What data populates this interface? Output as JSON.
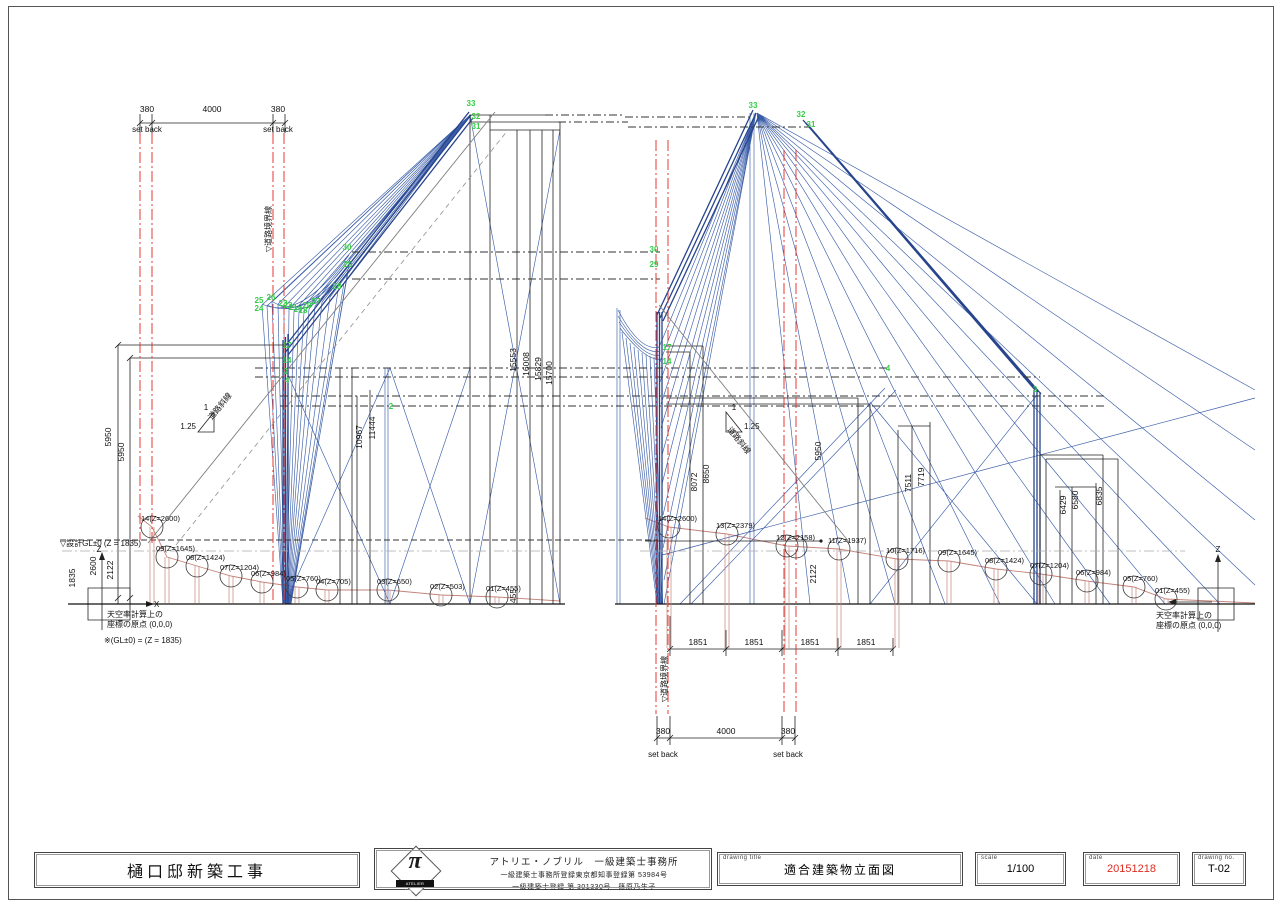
{
  "sheet": {
    "project": "樋口邸新築工事",
    "office_name": "アトリエ・ノブリル　一級建築士事務所",
    "office_reg1": "一級建築士事務所登録東京都知事登録第 53984号",
    "office_reg2": "一級建築士登録 第 301330号　篠原乃生子",
    "logo_mark": "π",
    "logo_name": "ATELIER NOMBRIL",
    "label_drawing_title": "drawing title",
    "label_scale": "scale",
    "label_date": "date",
    "label_drawing_no": "drawing no.",
    "drawing_title": "適合建築物立面図",
    "scale": "1/100",
    "date": "20151218",
    "drawing_no": "T-02",
    "date_color": "#e02b20",
    "accent_road_line": "#e53935",
    "accent_sky_lines": "#3b5ea9",
    "accent_points": "#35cc47"
  },
  "drawing": {
    "dims": [
      {
        "t": "380",
        "x": 147,
        "y": 112
      },
      {
        "t": "4000",
        "x": 212,
        "y": 112
      },
      {
        "t": "380",
        "x": 278,
        "y": 112
      },
      {
        "t": "5950",
        "x": 111,
        "y": 437,
        "r": -90
      },
      {
        "t": "5950",
        "x": 124,
        "y": 452,
        "r": -90
      },
      {
        "t": "1835",
        "x": 75,
        "y": 578,
        "r": -90
      },
      {
        "t": "2600",
        "x": 96,
        "y": 566,
        "r": -90
      },
      {
        "t": "2122",
        "x": 113,
        "y": 570,
        "r": -90
      },
      {
        "t": "10967",
        "x": 362,
        "y": 437,
        "r": -90
      },
      {
        "t": "11444",
        "x": 375,
        "y": 428,
        "r": -90
      },
      {
        "t": "15553",
        "x": 516,
        "y": 360,
        "r": -90
      },
      {
        "t": "16008",
        "x": 529,
        "y": 364,
        "r": -90
      },
      {
        "t": "15829",
        "x": 541,
        "y": 369,
        "r": -90
      },
      {
        "t": "15700",
        "x": 552,
        "y": 373,
        "r": -90
      },
      {
        "t": "455",
        "x": 516,
        "y": 596,
        "r": -90
      },
      {
        "t": "8072",
        "x": 697,
        "y": 482,
        "r": -90
      },
      {
        "t": "8650",
        "x": 709,
        "y": 474,
        "r": -90
      },
      {
        "t": "5950",
        "x": 821,
        "y": 451,
        "r": -90
      },
      {
        "t": "2122",
        "x": 816,
        "y": 574,
        "r": -90
      },
      {
        "t": "7511",
        "x": 911,
        "y": 483,
        "r": -90
      },
      {
        "t": "7719",
        "x": 924,
        "y": 477,
        "r": -90
      },
      {
        "t": "6429",
        "x": 1066,
        "y": 505,
        "r": -90
      },
      {
        "t": "6580",
        "x": 1078,
        "y": 500,
        "r": -90
      },
      {
        "t": "6835",
        "x": 1102,
        "y": 496,
        "r": -90
      },
      {
        "t": "1851",
        "x": 698,
        "y": 645
      },
      {
        "t": "1851",
        "x": 754,
        "y": 645
      },
      {
        "t": "1851",
        "x": 810,
        "y": 645
      },
      {
        "t": "1851",
        "x": 866,
        "y": 645
      },
      {
        "t": "380",
        "x": 663,
        "y": 734
      },
      {
        "t": "4000",
        "x": 726,
        "y": 734
      },
      {
        "t": "380",
        "x": 788,
        "y": 734
      }
    ],
    "notes": [
      {
        "t": "set back",
        "x": 147,
        "y": 132
      },
      {
        "t": "set back",
        "x": 278,
        "y": 132
      },
      {
        "t": "set back",
        "x": 663,
        "y": 757
      },
      {
        "t": "set back",
        "x": 788,
        "y": 757
      },
      {
        "t": "▽道路境界線",
        "x": 271,
        "y": 252,
        "a": "start",
        "r": -90
      },
      {
        "t": "▽道路境界線",
        "x": 667,
        "y": 702,
        "a": "start",
        "r": -90
      },
      {
        "t": "▽設計GL±0 (Z = 1835)",
        "x": 60,
        "y": 546,
        "a": "start"
      },
      {
        "t": "天空率計算上の",
        "x": 107,
        "y": 617,
        "a": "start"
      },
      {
        "t": "座標の原点 (0,0,0)",
        "x": 107,
        "y": 627,
        "a": "start"
      },
      {
        "t": "※(GL±0) = (Z = 1835)",
        "x": 104,
        "y": 643,
        "a": "start"
      },
      {
        "t": "天空率計算上の",
        "x": 1156,
        "y": 618,
        "a": "start"
      },
      {
        "t": "座標の原点 (0,0,0)",
        "x": 1156,
        "y": 628,
        "a": "start"
      },
      {
        "t": "道路斜線",
        "x": 222,
        "y": 408,
        "r": -51
      },
      {
        "t": "道路斜線",
        "x": 737,
        "y": 442,
        "r": 51
      },
      {
        "t": "1.25",
        "x": 196,
        "y": 429,
        "a": "end"
      },
      {
        "t": "1",
        "x": 206,
        "y": 410
      },
      {
        "t": "1.25",
        "x": 744,
        "y": 429,
        "a": "start"
      },
      {
        "t": "1",
        "x": 734,
        "y": 410
      },
      {
        "t": "Z",
        "x": 99,
        "y": 552
      },
      {
        "t": "X",
        "x": 154,
        "y": 607,
        "a": "start"
      },
      {
        "t": "Z",
        "x": 1218,
        "y": 552
      }
    ],
    "points": [
      {
        "t": "33",
        "x": 471,
        "y": 106
      },
      {
        "t": "32",
        "x": 476,
        "y": 119
      },
      {
        "t": "31",
        "x": 476,
        "y": 129
      },
      {
        "t": "33",
        "x": 753,
        "y": 108
      },
      {
        "t": "32",
        "x": 801,
        "y": 117
      },
      {
        "t": "31",
        "x": 811,
        "y": 127
      },
      {
        "t": "30",
        "x": 347,
        "y": 250
      },
      {
        "t": "29",
        "x": 348,
        "y": 267
      },
      {
        "t": "28",
        "x": 337,
        "y": 289
      },
      {
        "t": "25",
        "x": 259,
        "y": 303
      },
      {
        "t": "24",
        "x": 259,
        "y": 311
      },
      {
        "t": "26",
        "x": 271,
        "y": 300
      },
      {
        "t": "23",
        "x": 283,
        "y": 306
      },
      {
        "t": "22",
        "x": 288,
        "y": 308
      },
      {
        "t": "21",
        "x": 293,
        "y": 310
      },
      {
        "t": "19",
        "x": 298,
        "y": 312
      },
      {
        "t": "18",
        "x": 303,
        "y": 313
      },
      {
        "t": "20",
        "x": 307,
        "y": 308
      },
      {
        "t": "27",
        "x": 316,
        "y": 304
      },
      {
        "t": "17",
        "x": 287,
        "y": 348
      },
      {
        "t": "14",
        "x": 287,
        "y": 363
      },
      {
        "t": "3",
        "x": 286,
        "y": 374
      },
      {
        "t": "4",
        "x": 287,
        "y": 383
      },
      {
        "t": "2",
        "x": 391,
        "y": 409
      },
      {
        "t": "30",
        "x": 654,
        "y": 252
      },
      {
        "t": "29",
        "x": 654,
        "y": 267
      },
      {
        "t": "17",
        "x": 667,
        "y": 350
      },
      {
        "t": "14",
        "x": 667,
        "y": 364
      },
      {
        "t": "4",
        "x": 888,
        "y": 371
      },
      {
        "t": "3",
        "x": 1035,
        "y": 392
      }
    ],
    "markers": [
      {
        "t": "14(Z=2600)",
        "cx": 152,
        "cy": 527,
        "side": "L"
      },
      {
        "t": "09(Z=1645)",
        "cx": 167,
        "cy": 557,
        "side": "L"
      },
      {
        "t": "08(Z=1424)",
        "cx": 197,
        "cy": 566,
        "side": "L"
      },
      {
        "t": "07(Z=1204)",
        "cx": 231,
        "cy": 576,
        "side": "L"
      },
      {
        "t": "06(Z=984)",
        "cx": 262,
        "cy": 582,
        "side": "L"
      },
      {
        "t": "05(Z=760)",
        "cx": 297,
        "cy": 587,
        "side": "L"
      },
      {
        "t": "04(Z=705)",
        "cx": 327,
        "cy": 590,
        "side": "L"
      },
      {
        "t": "03(Z=650)",
        "cx": 388,
        "cy": 590,
        "side": "L"
      },
      {
        "t": "02(Z=503)",
        "cx": 441,
        "cy": 595,
        "side": "L"
      },
      {
        "t": "01(Z=455)",
        "cx": 497,
        "cy": 597,
        "side": "L"
      },
      {
        "t": "14(Z=2600)",
        "cx": 669,
        "cy": 527,
        "side": "R",
        "deep": 1
      },
      {
        "t": "13(Z=2379)",
        "cx": 727,
        "cy": 534,
        "side": "R",
        "deep": 1
      },
      {
        "t": "12(Z=2158)",
        "cx": 787,
        "cy": 546,
        "c2": 796,
        "side": "R",
        "deep": 1
      },
      {
        "t": "11(Z=1937)",
        "cx": 839,
        "cy": 549,
        "side": "R",
        "deep": 1
      },
      {
        "t": "10(Z=1716)",
        "cx": 897,
        "cy": 559,
        "side": "R",
        "deep": 1
      },
      {
        "t": "09(Z=1645)",
        "cx": 949,
        "cy": 561,
        "side": "R"
      },
      {
        "t": "08(Z=1424)",
        "cx": 996,
        "cy": 569,
        "side": "R"
      },
      {
        "t": "07(Z=1204)",
        "cx": 1041,
        "cy": 574,
        "side": "R"
      },
      {
        "t": "06(Z=984)",
        "cx": 1087,
        "cy": 581,
        "side": "R"
      },
      {
        "t": "05(Z=760)",
        "cx": 1134,
        "cy": 587,
        "side": "R"
      },
      {
        "t": "01(Z=455)",
        "cx": 1166,
        "cy": 599,
        "side": "R"
      }
    ]
  }
}
